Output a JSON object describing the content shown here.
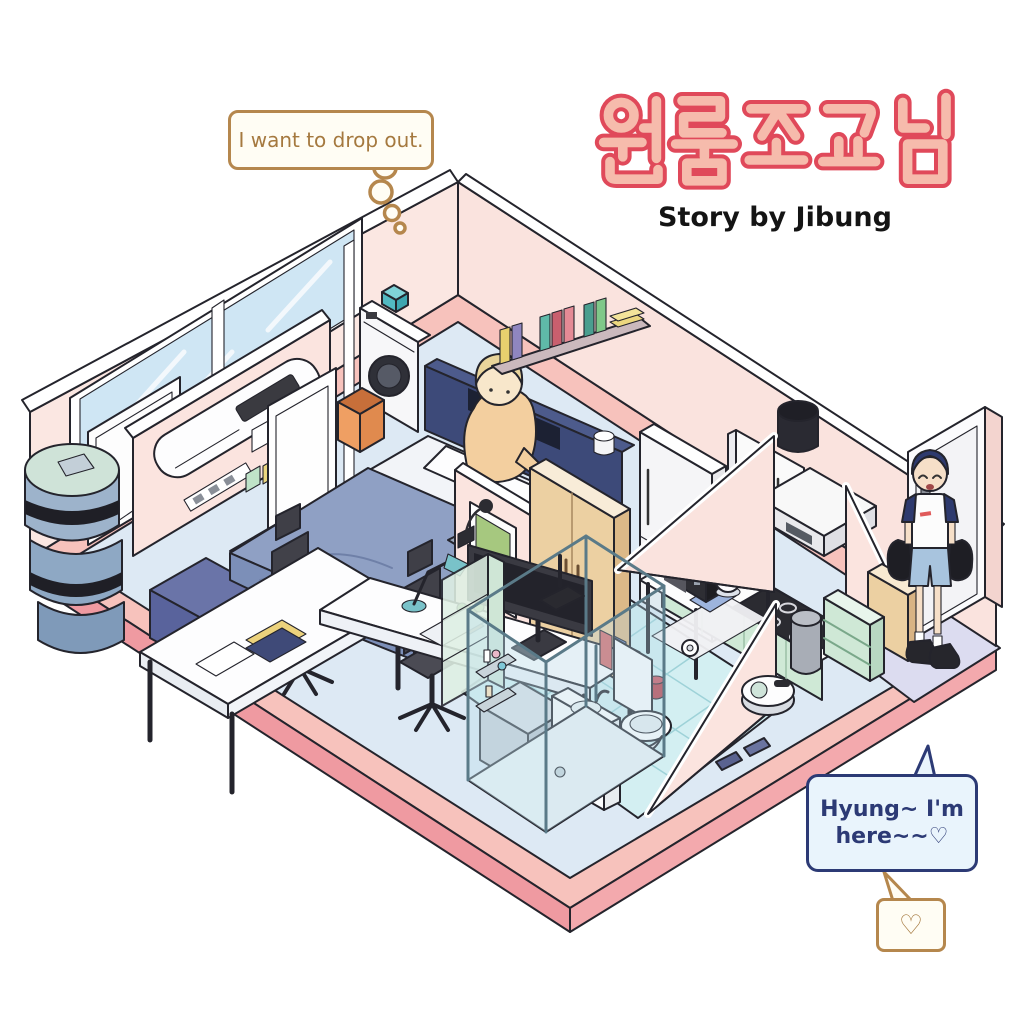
{
  "title": {
    "text": "원룸조교님",
    "subtitle": "Story by Jibung",
    "letter_fill": "#f6bbac",
    "letter_outline": "#e0495a"
  },
  "speech_bubbles": {
    "dropout": {
      "text": "I want to drop out.",
      "border": "#b5874d",
      "text_color": "#a5793f"
    },
    "arrival": {
      "line1": "Hyung~ I'm",
      "line2": "here~~♡",
      "border": "#2c3a75",
      "fill": "#e9f4fc"
    },
    "heart": {
      "symbol": "♡",
      "border": "#b5874d"
    }
  },
  "palette": {
    "wall_pink": "#fbe7e2",
    "floor_blue": "#dde9f4",
    "floor_rim_pink": "#f7c2bc",
    "tile_cyan": "#d3eff2",
    "entry_mat": "#dcdcf0",
    "mint": "#cfe9d6",
    "wood_tan": "#ecd0a2",
    "navy": "#3d4a79",
    "blanket_blue": "#8fa0c4"
  },
  "scene": {
    "room_label": "isometric one-room studio apartment cutaway",
    "objects": [
      "window",
      "washing-machine",
      "detergent-box",
      "laundry-basket",
      "bed",
      "pillows",
      "headboard-shelf",
      "wall-book-shelf",
      "air-conditioner",
      "sticky-notes",
      "laptop-desk",
      "laptop",
      "open-door",
      "room-door",
      "futon-rolls",
      "storage-boxes",
      "long-desk",
      "monitor",
      "desk-lamp",
      "office-chair",
      "office-chair-2",
      "drawer-unit",
      "glass-display-cabinet",
      "wardrobe",
      "poster",
      "toiletry-shelf",
      "mint-cabinet",
      "shower-enclosure",
      "shower-head",
      "vanity-sink",
      "toilet",
      "toilet-paper",
      "slippers",
      "tiled-floor",
      "fridge",
      "wall-cabinet",
      "range-hood",
      "kitchen-counter",
      "sink",
      "cooktop",
      "trash-can",
      "appliance-table",
      "microwave",
      "electric-kettle",
      "robot-vacuum",
      "stool",
      "shoe-shelf",
      "entry-cabinet",
      "front-door",
      "entry-mat",
      "light-switch",
      "wall-outlet"
    ],
    "characters": [
      {
        "id": "roommate-on-bed",
        "desc": "blonde person in beige sweater sitting on bed"
      },
      {
        "id": "visitor-at-door",
        "desc": "blue-haired person with bags arriving at front door"
      }
    ]
  }
}
